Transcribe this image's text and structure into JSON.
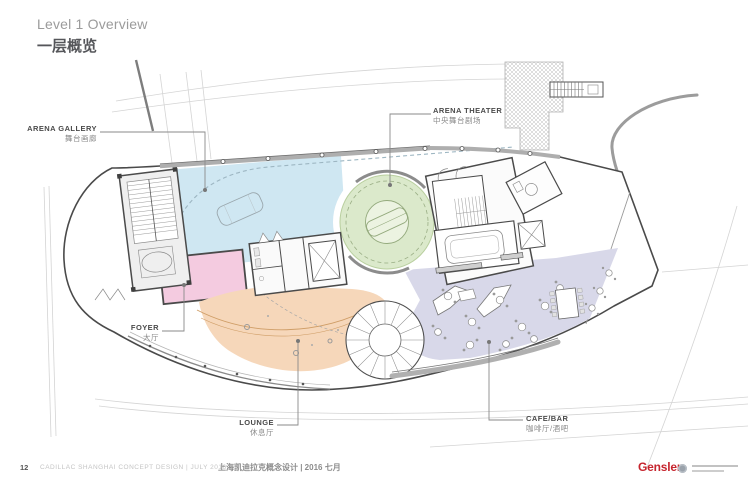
{
  "header": {
    "title_en": "Level 1 Overview",
    "title_zh": "一层概览"
  },
  "plan": {
    "zones": [
      {
        "id": "arena-gallery",
        "label_en": "ARENA GALLERY",
        "label_zh": "舞台画廊",
        "color": "#cfe7f2"
      },
      {
        "id": "arena-theater",
        "label_en": "ARENA THEATER",
        "label_zh": "中央舞台剧场",
        "color": "#dbe9cb"
      },
      {
        "id": "foyer",
        "label_en": "FOYER",
        "label_zh": "大厅",
        "color": "#f4cbe0"
      },
      {
        "id": "lounge",
        "label_en": "LOUNGE",
        "label_zh": "休息厅",
        "color": "#f6d7ba"
      },
      {
        "id": "cafe-bar",
        "label_en": "CAFE/BAR",
        "label_zh": "咖啡厅/酒吧",
        "color": "#d8d8e9"
      }
    ]
  },
  "footer": {
    "page_number": "12",
    "doc_title_en": "CADILLAC SHANGHAI CONCEPT DESIGN  |  JULY 2016",
    "doc_title_zh": "上海凯迪拉克概念设计 | 2016 七月",
    "brand": "Gensler",
    "brand_color": "#c6252e"
  }
}
